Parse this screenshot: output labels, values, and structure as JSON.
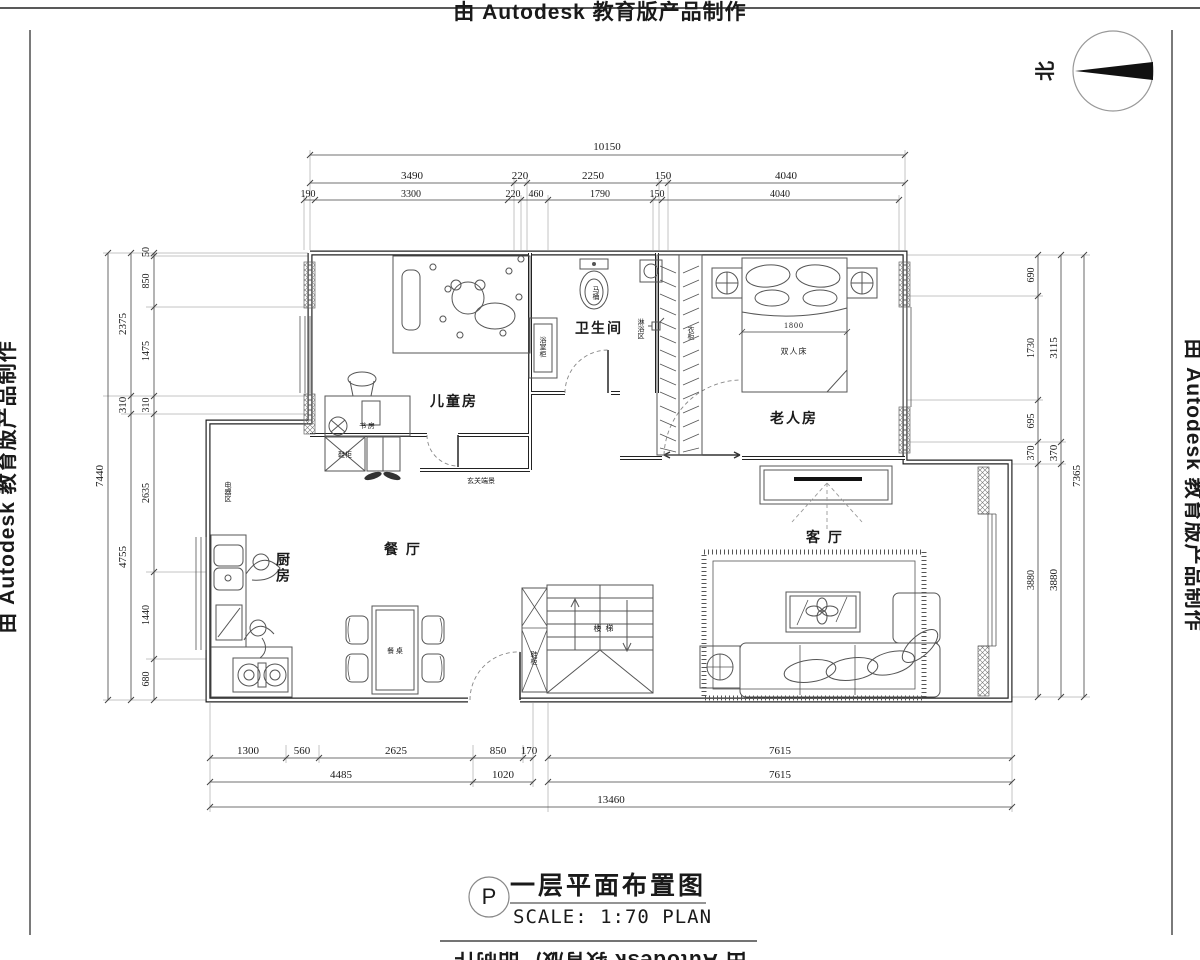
{
  "edge": {
    "autodesk": "由 Autodesk 教育版产品制作"
  },
  "north": {
    "label": "北"
  },
  "title_block": {
    "tag": "P",
    "title": "一层平面布置图",
    "scale": "SCALE: 1:70 PLAN"
  },
  "rooms": {
    "children": "儿童房",
    "bathroom": "卫生间",
    "elderly": "老人房",
    "dining": "餐 厅",
    "living": "客 厅",
    "kitchen": "厨房"
  },
  "labels": {
    "study": "书 房",
    "shoe_cabinet_entry": "鞋柜",
    "entry_view": "玄关端景",
    "toilet": "马桶",
    "shower_area": "淋浴区",
    "bath_cabinet": "浴室柜",
    "wardrobe": "衣柜",
    "double_bed": "双人床",
    "appliance_area": "电器区",
    "dining_table": "餐 桌",
    "stairs": "楼 梯",
    "shoe_cabinet_stairs": "鞋柜"
  },
  "dims": {
    "bed": "1800",
    "top": {
      "total": "10150",
      "row2": [
        "3490",
        "220",
        "2250",
        "150",
        "4040"
      ],
      "row3": [
        "190",
        "3300",
        "220",
        "460",
        "1790",
        "150",
        "4040"
      ]
    },
    "left": {
      "outer": "7440",
      "middle": [
        "2375",
        "310",
        "4755"
      ],
      "inner": [
        "50",
        "850",
        "1475",
        "310",
        "2635",
        "1440",
        "680"
      ]
    },
    "right": {
      "outer": "7365",
      "middle": [
        "3115",
        "370",
        "3880"
      ],
      "inner": [
        "690",
        "1730",
        "695",
        "370",
        "3880"
      ]
    },
    "bottom": {
      "row1": [
        "1300",
        "560",
        "2625",
        "850",
        "170",
        "7615"
      ],
      "row2": [
        "4485",
        "1020",
        "7615"
      ],
      "row3": "13460"
    }
  }
}
